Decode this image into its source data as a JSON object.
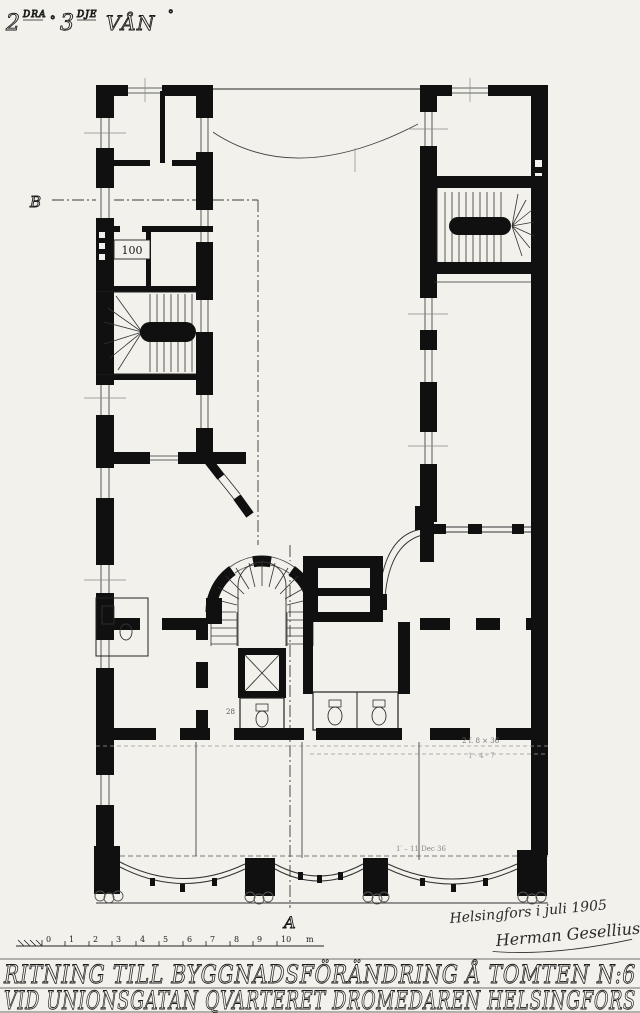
{
  "paper_color": "#f2f1ec",
  "ink_color": "#101010",
  "title": {
    "floor_2": "2",
    "floor_2_suffix": "DRA",
    "separator": "°",
    "floor_3": "3",
    "floor_3_suffix": "DJE",
    "floor_word": "VÅN",
    "degree": "°"
  },
  "section_markers": {
    "b": "B",
    "a": "A"
  },
  "plan_labels": {
    "box_label": "100",
    "wc_number": "28"
  },
  "annotations": {
    "dim_right_1": "2 f. 8 × 36",
    "dim_right_2": "1 · 4 · 7",
    "facade_note": "1′ – 11 Dec 36"
  },
  "scale_bar": {
    "ticks": [
      "0",
      "1",
      "2",
      "3",
      "4",
      "5",
      "6",
      "7",
      "8",
      "9",
      "10"
    ],
    "unit": "m"
  },
  "signature": {
    "place_date": "Helsingfors i juli 1905",
    "name": "Herman Gesellius"
  },
  "caption": {
    "line1": "RITNING TILL BYGGNADSFÖRÄNDRING Å TOMTEN N:6",
    "line2": "VID UNIONSGATAN QVARTERET DROMEDAREN HELSINGFORS"
  }
}
